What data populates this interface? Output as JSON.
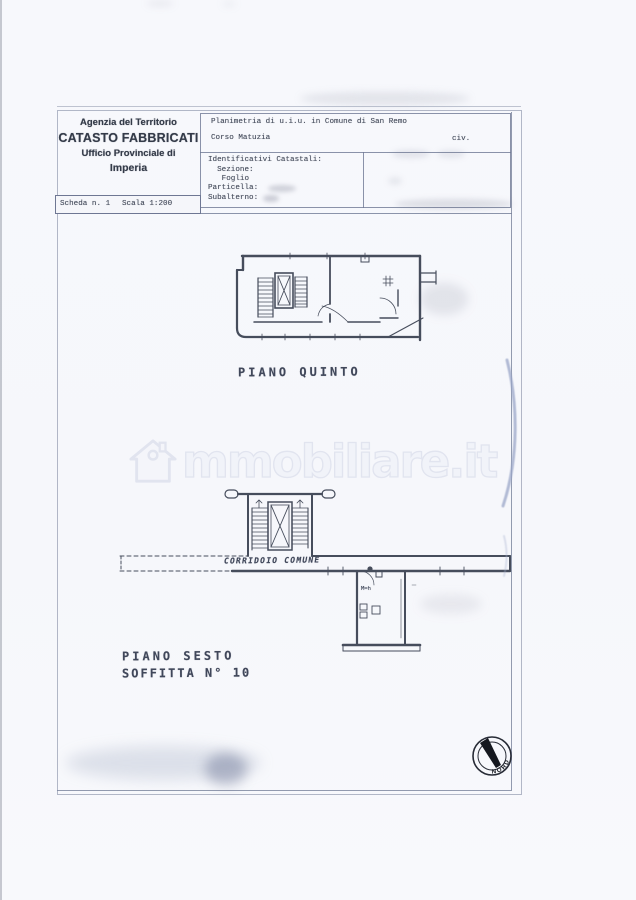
{
  "header": {
    "agency": {
      "line1": "Agenzia del Territorio",
      "line2": "CATASTO FABBRICATI",
      "line3": "Ufficio Provinciale di",
      "line4": "Imperia"
    },
    "planimetria": {
      "title": "Planimetria di u.i.u. in Comune di San Remo",
      "street": "Corso Matuzia",
      "civic": "civ."
    },
    "catastali": {
      "title": "Identificativi Catastali:",
      "row_sezione": "  Sezione:",
      "row_foglio": "   Foglio",
      "row_particella": "Particella:",
      "row_subalterno": "Subalterno:"
    },
    "scheda": {
      "sheet": "Scheda n. 1",
      "scale": "Scala 1:200"
    }
  },
  "plans": {
    "fifth": {
      "caption": "PIANO QUINTO"
    },
    "sixth": {
      "caption": "PIANO SESTO",
      "caption2": "SOFFITTA N° 10",
      "corridor_label": "CORRIDOIO COMUNE",
      "room_note": "M=h"
    }
  },
  "compass": {
    "label": "NORD"
  },
  "watermark": {
    "brand": "immobiliare.it",
    "display_text": "mmobiliare.it"
  },
  "colors": {
    "plan_line": "#464d5c",
    "frame_line": "#7a849b",
    "watermark_gray": "#e1e4ef"
  }
}
